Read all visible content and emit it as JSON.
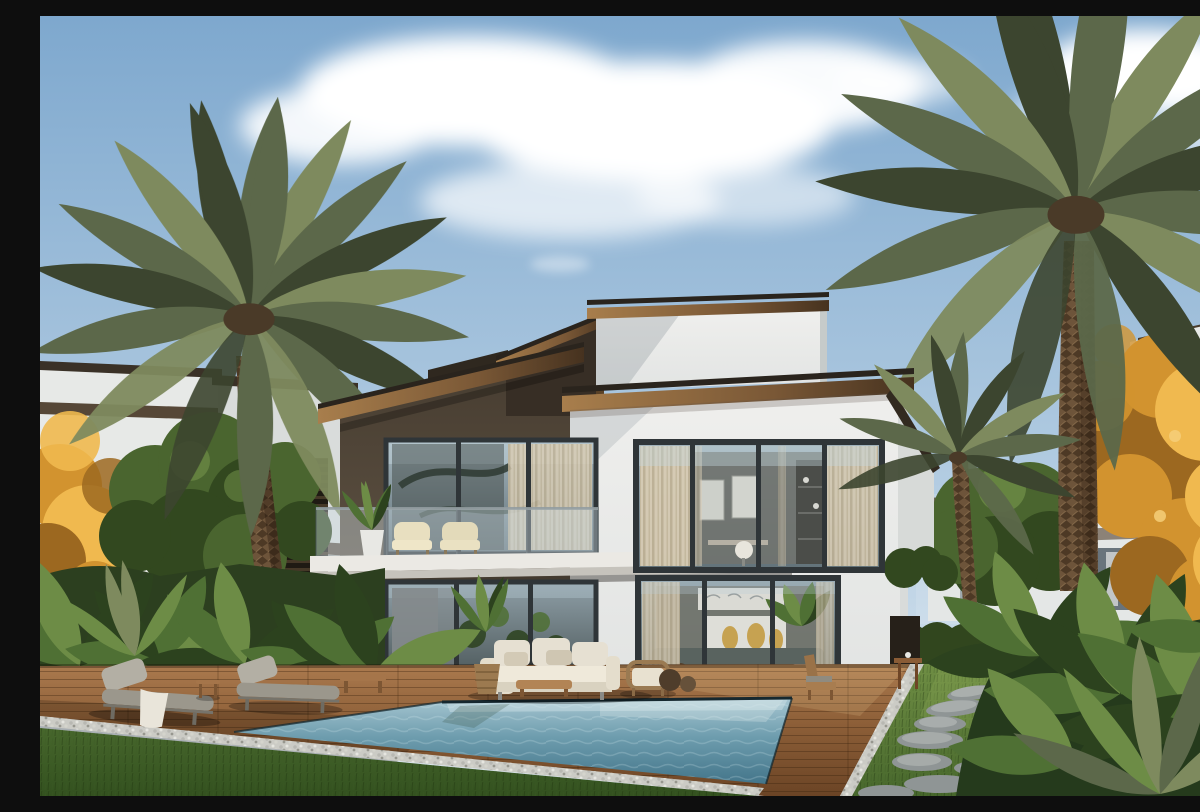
{
  "scene": {
    "title": "Daytime architectural render: modern two-story villa with dark-bronze and white volumes, floor-to-ceiling glazing, balcony, wooden pool deck, swimming pool, sun loungers, outdoor sofa, lawns, date palms, autumn tree and tropical garden",
    "time_of_day": "day",
    "elements": [
      "sky",
      "clouds",
      "left neighbor villa",
      "right neighbor building",
      "background townhouse",
      "green trees",
      "autumn golden trees",
      "date palm left",
      "date palm right",
      "small palm",
      "main villa",
      "bronze roof fascia",
      "balcony with glass railing",
      "balcony plant and chairs",
      "large glazed windows",
      "interior living room",
      "interior study",
      "wood pool deck",
      "pebble border",
      "swimming pool",
      "lawn",
      "stepping stone path",
      "sun loungers",
      "towel",
      "side tables",
      "outdoor sofa set",
      "armchair",
      "potted plants",
      "tropical garden",
      "hedge"
    ]
  },
  "colors": {
    "sky-top": "#7ea8ce",
    "sky-mid": "#aec9e0",
    "sky-low": "#dde8f0",
    "cloud": "#ffffff",
    "stucco-white": "#efefed",
    "stucco-white-shade": "#d5d8d7",
    "stucco-dark-top": "#463c30",
    "stucco-dark-bottom": "#675a4a",
    "fascia-lit": "#a87e4c",
    "fascia-mid": "#7a5836",
    "fascia-dark": "#46321f",
    "fascia-cap": "#2a241d",
    "frame-dark": "#2f3538",
    "glass-top": "#a3b4bc",
    "glass-bottom": "#63737a",
    "glass-deep": "#4e5a5c",
    "curtain": "#d8ccb4",
    "balcony-slab": "#ebe9e4",
    "deck-back": "#ab7a4e",
    "deck-mid": "#8d5f38",
    "deck-front": "#6b4425",
    "pebble": "#cbcbc5",
    "water-back": "#a7c6d1",
    "water-mid": "#6e9dae",
    "water-front": "#43758a",
    "waterline": "#16282f",
    "grass-back": "#6f8e44",
    "grass-mid": "#47672c",
    "grass-front": "#33511f",
    "hedge": "#31461e",
    "palm-lit": "#7e8a5e",
    "palm-mid": "#5c684a",
    "palm-dark": "#3c452f",
    "trunk": "#6d543a",
    "trunk-dark": "#4a3a28",
    "tree-green": "#4a652f",
    "tree-green-dark": "#32481f",
    "tree-green-lit": "#6d8c46",
    "autumn-hi": "#f0b94f",
    "autumn-mid": "#d2932f",
    "autumn-dark": "#9c6820",
    "neighbor-white": "#e7e9e7",
    "neighbor-shade": "#d9dcdb",
    "band-brown": "#4e3e2d",
    "bg-building": "#e3e6e3",
    "sofa-cream": "#e6e0d2",
    "cushion-shade": "#d3cab6",
    "lounger-gray": "#9b978c",
    "pillow-gray": "#b3afa4",
    "wood-furniture": "#a5754a",
    "stone-gray": "#8f9595",
    "stone-light": "#b5bab8",
    "pot-white": "#e8e8e4",
    "plant-green": "#4f7034",
    "plant-dark": "#2c421e"
  }
}
